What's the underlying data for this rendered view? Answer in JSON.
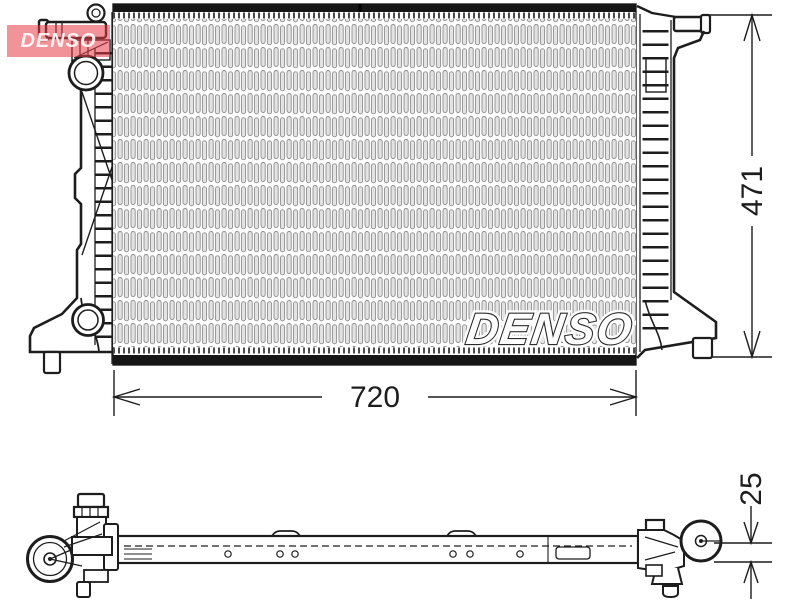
{
  "page": {
    "title": "DENSO radiator technical line drawing, front view and bottom view with dimensions",
    "background": "#ffffff"
  },
  "watermark": {
    "text": "DENSO",
    "color": "#e83846"
  },
  "front_view": {
    "logo_text": "DENSO"
  },
  "dimensions": {
    "width": "720",
    "height": "471",
    "depth": "25"
  },
  "colors": {
    "line": "#1d1d1d",
    "header_band": "#161616",
    "fin_fill": "#e3e3e3",
    "fin_stroke": "#8d8d8d",
    "watermark_red": "#e83846",
    "logo_outline": "#2a2a2a"
  }
}
